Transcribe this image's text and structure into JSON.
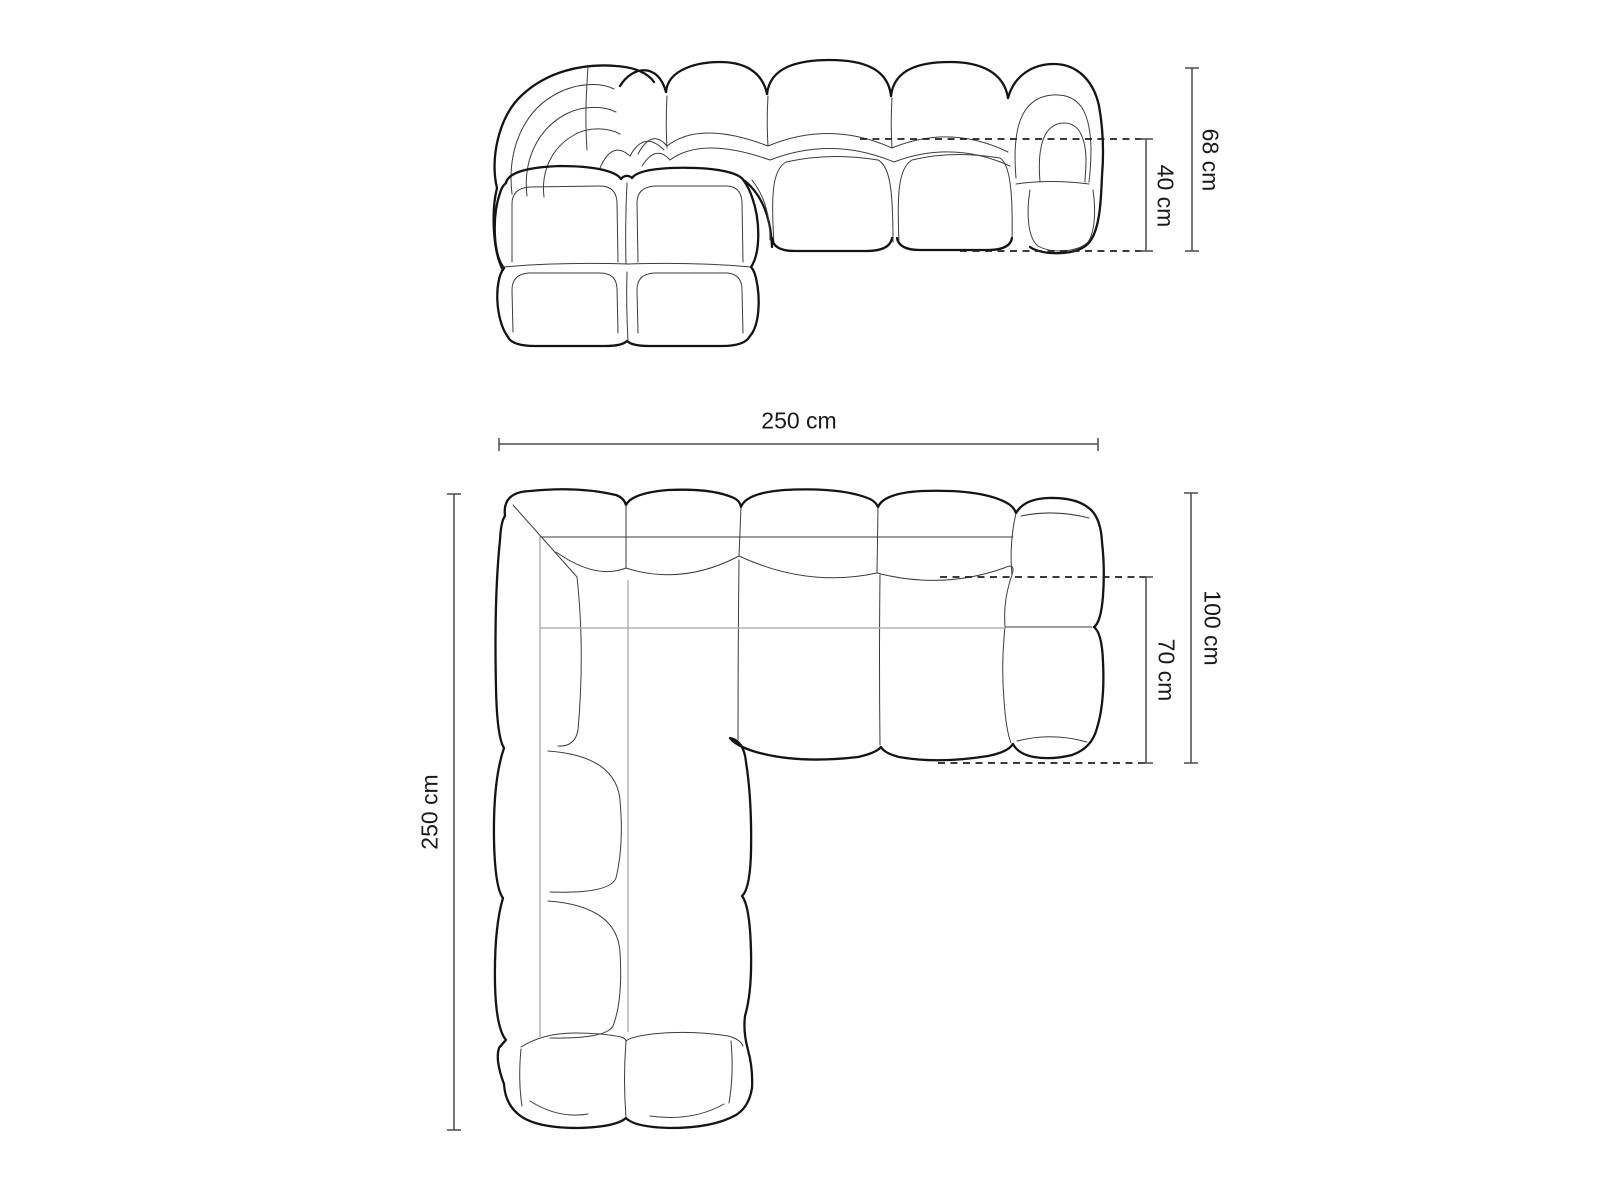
{
  "colors": {
    "background": "#ffffff",
    "outline": "#141414",
    "seam": "#3c3c3c",
    "guide": "#b4b4b4",
    "dimension_line": "#4a4a4a",
    "text": "#1a1a1a"
  },
  "front_view": {
    "height_label": "68 cm",
    "seat_height_label": "40 cm"
  },
  "top_view": {
    "width_label": "250 cm",
    "depth_label": "250 cm",
    "chaise_depth_label": "100 cm",
    "seat_depth_label": "70 cm"
  }
}
